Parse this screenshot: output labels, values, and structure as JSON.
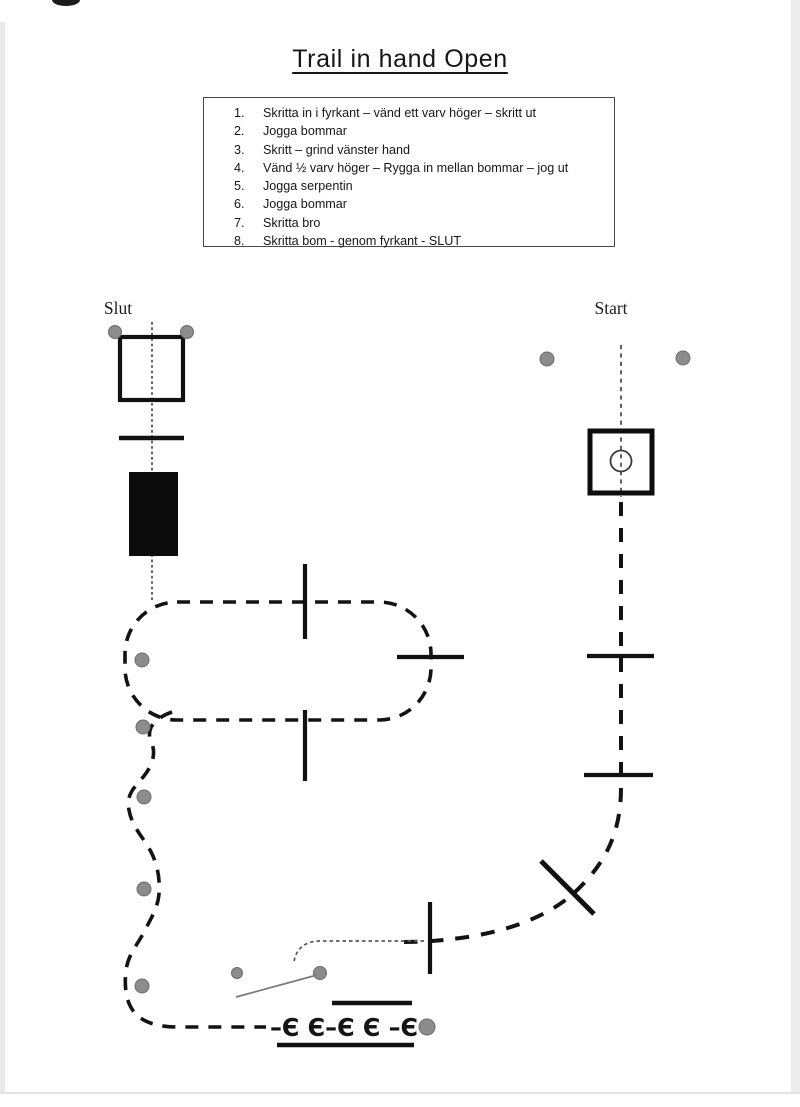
{
  "page": {
    "title": "Trail in hand Open"
  },
  "instructions": {
    "items": [
      {
        "num": "1.",
        "text": "Skritta in i fyrkant – vänd ett varv höger – skritt ut"
      },
      {
        "num": "2.",
        "text": "Jogga bommar"
      },
      {
        "num": "3.",
        "text": "Skritt – grind vänster hand"
      },
      {
        "num": "4.",
        "text": "Vänd ½ varv höger – Rygga in mellan bommar – jog ut"
      },
      {
        "num": "5.",
        "text": "Jogga serpentin"
      },
      {
        "num": "6.",
        "text": "Jogga bommar"
      },
      {
        "num": "7.",
        "text": "Skritta bro"
      },
      {
        "num": "8.",
        "text": "Skritta bom - genom fyrkant - SLUT"
      }
    ]
  },
  "diagram": {
    "end_label": "Slut",
    "start_label": "Start",
    "pole_row_text": "–Є Є–Є Є –Є",
    "colors": {
      "ink": "#111111",
      "marker_gray": "#8c8c8c",
      "page_edge": "#e9e9ee"
    }
  }
}
